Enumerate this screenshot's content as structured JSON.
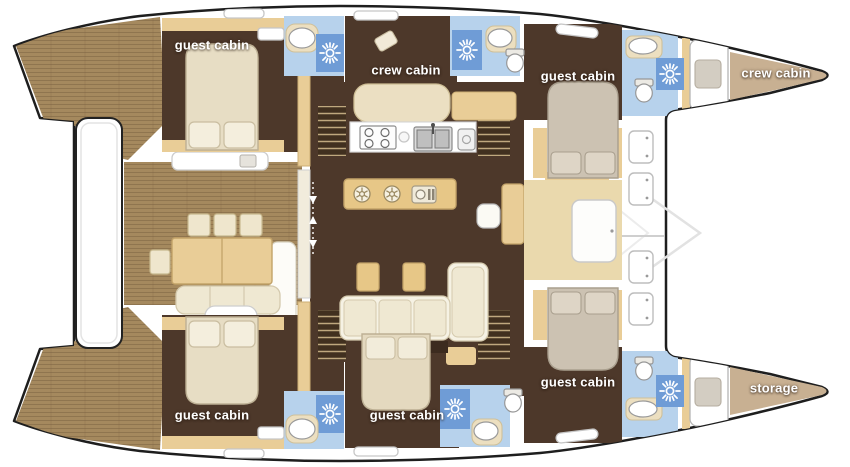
{
  "diagram": {
    "type": "catamaran-yacht-deck-plan",
    "orientation": "bow-right",
    "rooms": [
      {
        "id": "guest-cabin-port-aft",
        "label": "guest cabin"
      },
      {
        "id": "crew-cabin-port-mid",
        "label": "crew cabin"
      },
      {
        "id": "guest-cabin-port-fwd",
        "label": "guest cabin"
      },
      {
        "id": "crew-cabin-port-bow",
        "label": "crew cabin"
      },
      {
        "id": "guest-cabin-stbd-aft",
        "label": "guest cabin"
      },
      {
        "id": "guest-cabin-stbd-mid",
        "label": "guest cabin"
      },
      {
        "id": "guest-cabin-stbd-fwd",
        "label": "guest cabin"
      },
      {
        "id": "storage-stbd-bow",
        "label": "storage"
      }
    ],
    "colors": {
      "hull_outline": "#1e1e1e",
      "deck_wood": "#a5895e",
      "deck_wood_line": "#7e6442",
      "cabin_floor": "#4d382a",
      "furniture_tan": "#e9cd97",
      "furniture_cream": "#efe8d2",
      "bed_cream": "#e7ddc4",
      "bed_taupe": "#ccc2b2",
      "bathroom_blue": "#b7d2ec",
      "shower_tile_blue": "#6f9cd6",
      "bow_floor": "#c8b092",
      "white": "#ffffff"
    },
    "icons": [
      {
        "name": "shower-icon",
        "shape": "sun-rays"
      },
      {
        "name": "winch-icon",
        "shape": "spoked-circle"
      },
      {
        "name": "dish-icon",
        "shape": "plate-and-cutlery"
      },
      {
        "name": "stove-icon",
        "shape": "four-burners"
      },
      {
        "name": "double-sink-icon",
        "shape": "two-basins-faucet"
      },
      {
        "name": "toilet-icon",
        "shape": "bowl-with-tank"
      },
      {
        "name": "washbasin-icon",
        "shape": "oval-basin"
      },
      {
        "name": "deck-hatch-icon",
        "shape": "rounded-square-dots"
      },
      {
        "name": "walkway-arrows-icon",
        "shape": "up-down-arrows"
      }
    ]
  }
}
